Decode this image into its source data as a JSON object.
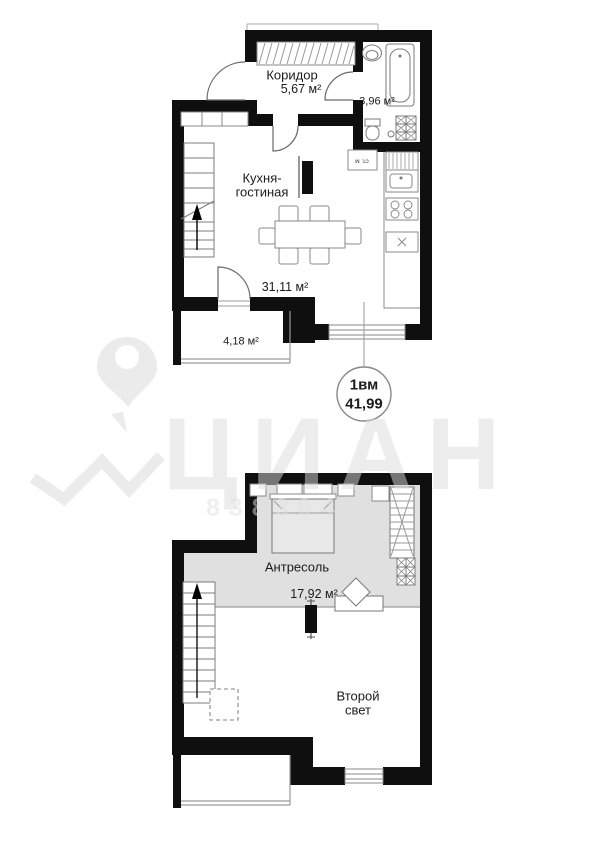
{
  "colors": {
    "walls": "#0f0f0f",
    "mezzanine_fill": "#e0e0e0",
    "furniture_stroke": "#888888",
    "watermark": "#dbdbdb"
  },
  "watermark": {
    "brand": "ЦИАН",
    "number": "8383948"
  },
  "upper_plan": {
    "corridor": {
      "name": "Коридор",
      "area": "5,67 м²"
    },
    "bathroom": {
      "area": "3,96 м²"
    },
    "kitchen_living": {
      "name_line1": "Кухня-",
      "name_line2": "гостиная",
      "area": "31,11 м²"
    },
    "balcony": {
      "area": "4,18 м²"
    },
    "washer_label": "ст. м",
    "callout": {
      "layout_type": "1вм",
      "total_area": "41,99"
    }
  },
  "lower_plan": {
    "mezzanine": {
      "name": "Антресоль",
      "area": "17,92 м²"
    },
    "second_light": {
      "name_line1": "Второй",
      "name_line2": "свет"
    }
  }
}
